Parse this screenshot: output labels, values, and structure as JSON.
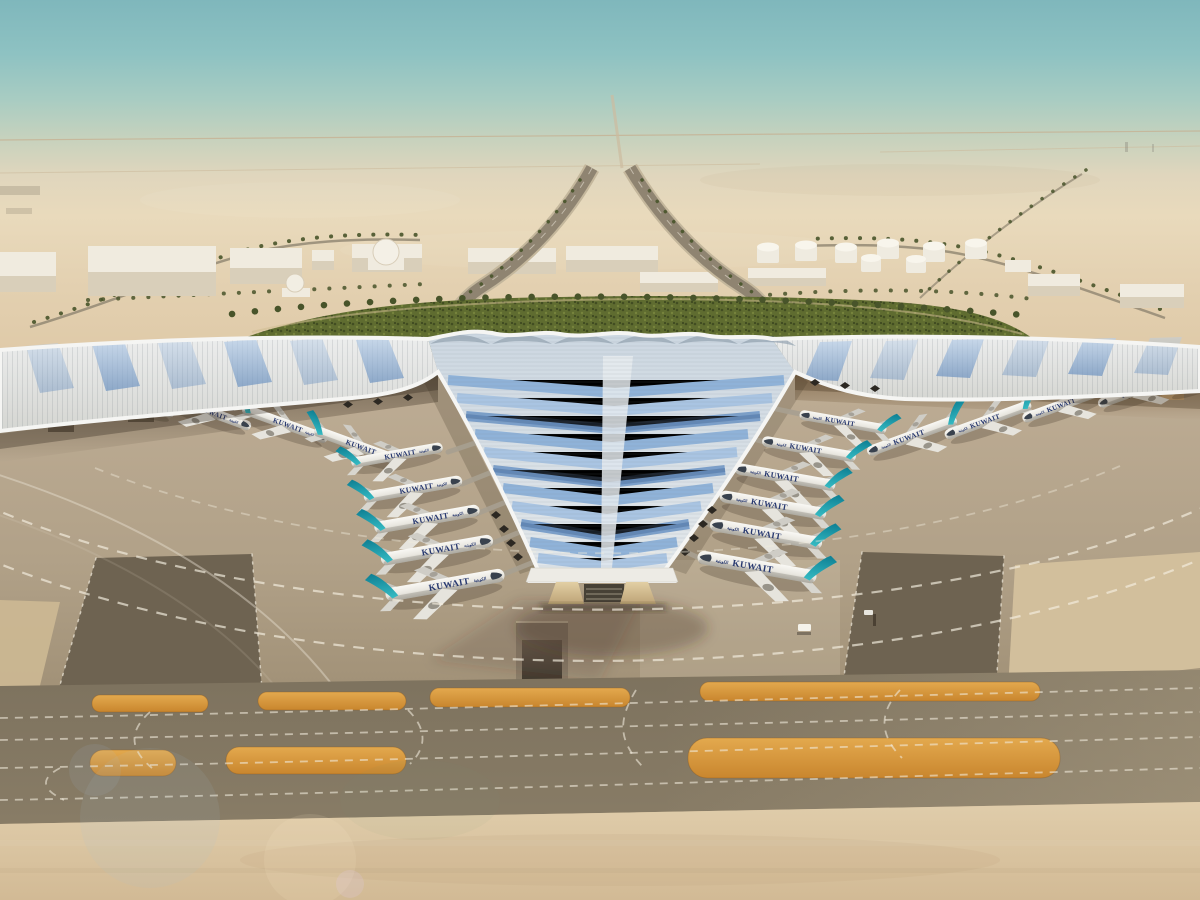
{
  "meta": {
    "title": "Kuwait International Airport terminal — aerial desert rendering"
  },
  "planes": {
    "label": "KUWAIT",
    "label_arabic": "الكويتية",
    "tail_color": "#21a0ae",
    "fuselage_color": "#f3f2ec",
    "counts": {
      "left_gates_inner": 5,
      "right_gates_inner": 6,
      "left_wing_gates": 5,
      "right_wing_gates": 4
    }
  },
  "terminal": {
    "roof_color": "#e8e9e7",
    "glazing_color": "#8fb2d8",
    "fascia_color": "#edebe5",
    "description_colors": {
      "spine": "#e6ebee",
      "scallop": "#93a2b0"
    }
  },
  "airfield": {
    "apron_color": "#b2a28a",
    "taxiway_color": "#756956",
    "marking_color": "#efe7d4",
    "sand_strip_color": "#d89a40"
  },
  "environment": {
    "sky_top": "#7fb7bc",
    "haze": "#e9dabc",
    "desert": "#d8c29e",
    "greenery": "#5f6c30",
    "palms": "#46512a",
    "buildings": "#efe9dc",
    "fuel_tanks_visible": 8
  }
}
